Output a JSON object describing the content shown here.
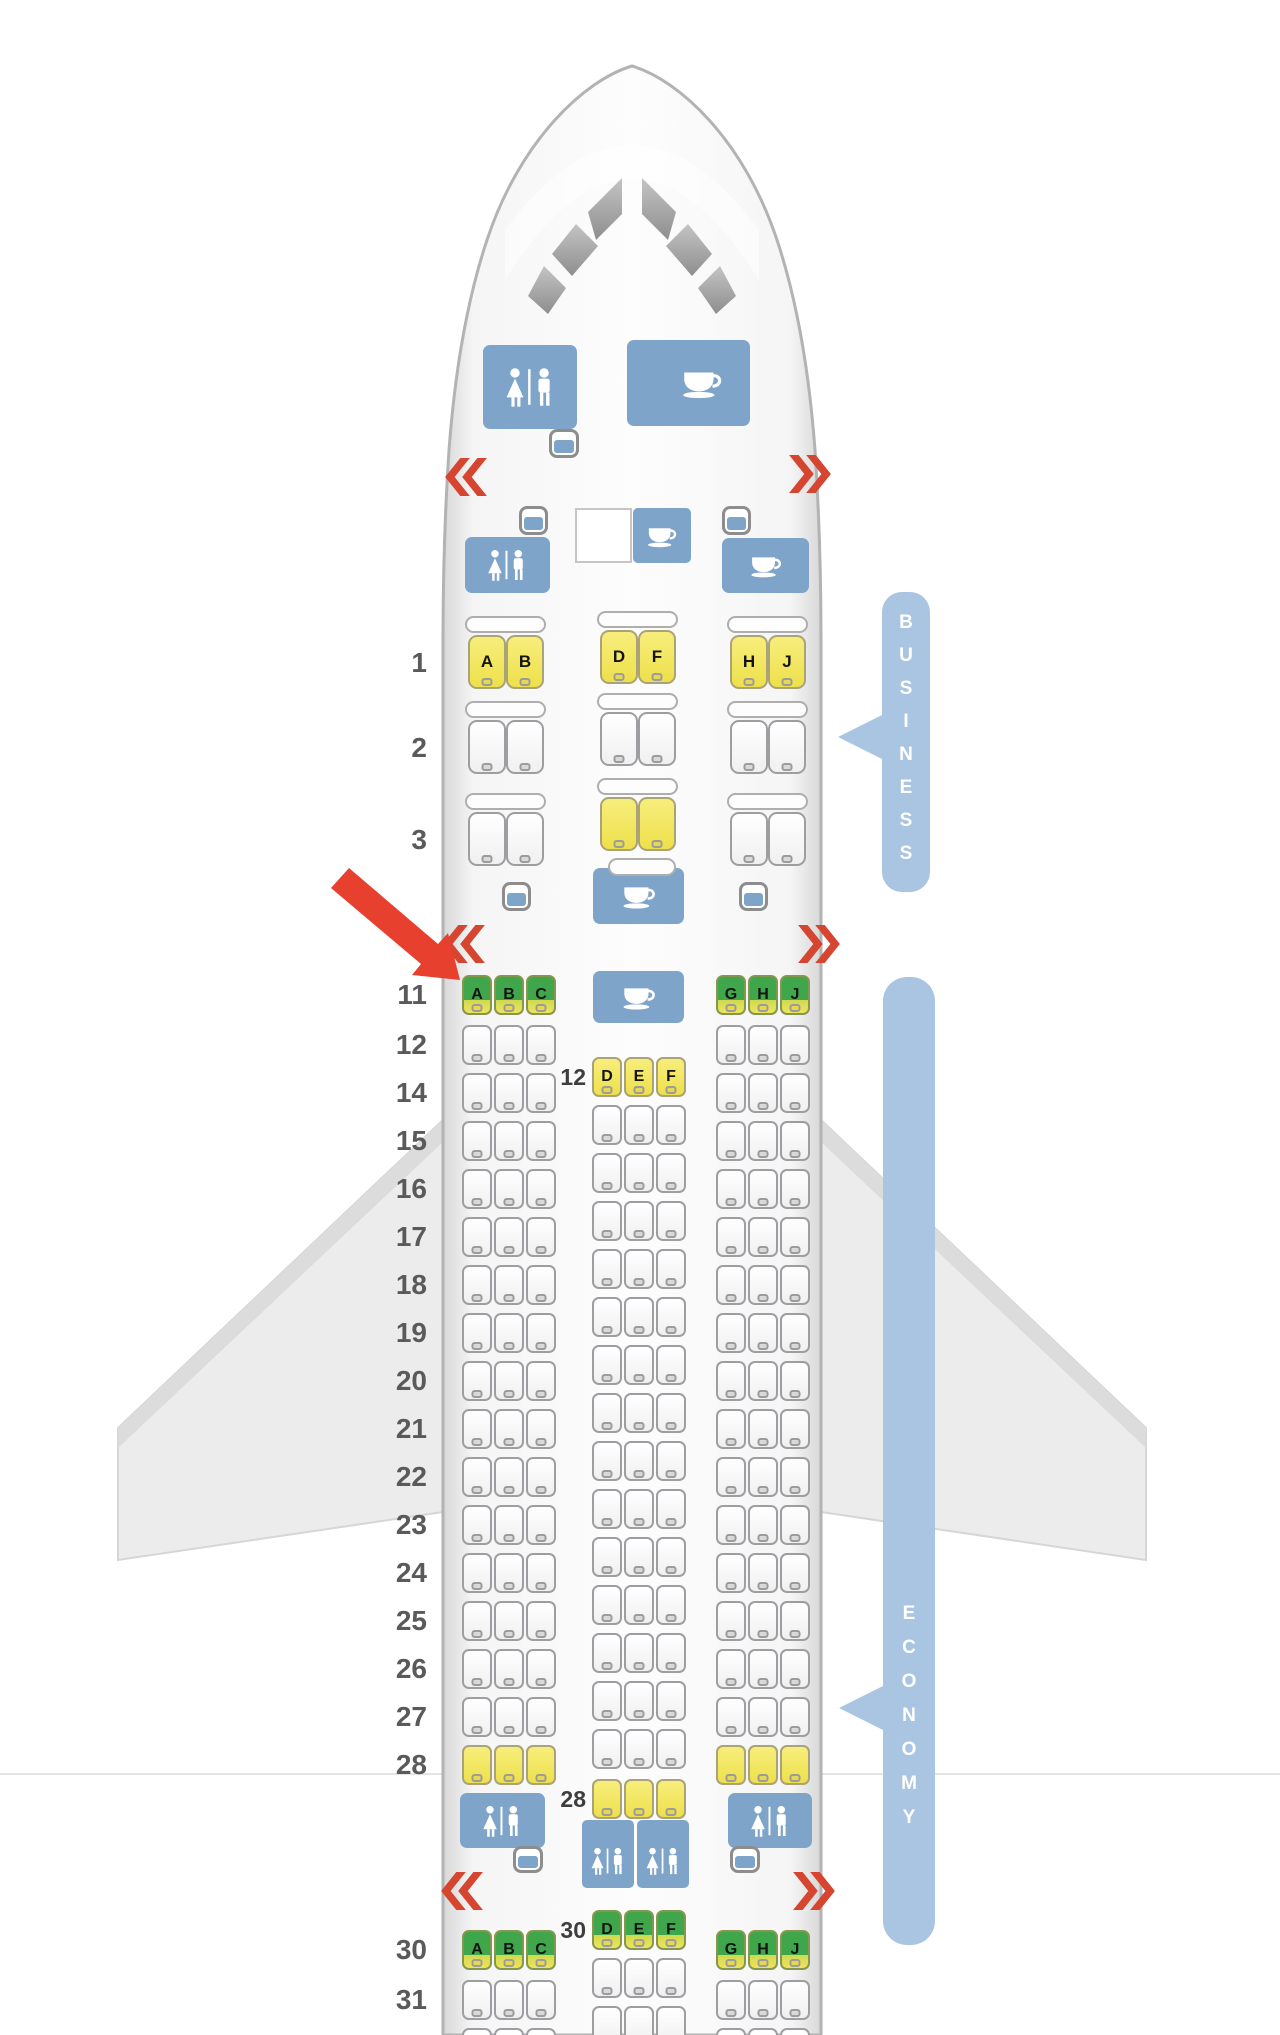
{
  "cabins": {
    "business_label": "BUSINESS",
    "economy_label": "ECONOMY"
  },
  "exits": {
    "left_glyph": "«",
    "right_glyph": "»"
  },
  "icons": {
    "lavatory": "wc-figures-icon",
    "galley": "coffee-cup-icon",
    "closet": "closet-icon",
    "exit_left": "red-double-chevron-left",
    "exit_right": "red-double-chevron-right",
    "pointer": "red-arrow-to-seat-11A"
  },
  "colors": {
    "fixture_blue": "#7ea4c9",
    "cabin_bar_blue": "#aac5e2",
    "seat_yellow": "#eee04b",
    "seat_green": "#3fa64b",
    "exit_red": "#d6452f",
    "arrow_red": "#e8402e"
  },
  "seatmap": {
    "columns": {
      "left": [
        "A",
        "B",
        "C"
      ],
      "center": [
        "D",
        "E",
        "F"
      ],
      "right": [
        "G",
        "H",
        "J"
      ]
    },
    "business_columns": {
      "left": [
        "A",
        "B"
      ],
      "center": [
        "D",
        "F"
      ],
      "right": [
        "H",
        "J"
      ]
    },
    "business_rows": [
      {
        "num": "1",
        "y_side": 635,
        "y_center": 630,
        "styles": [
          "yellow",
          "yellow",
          "yellow"
        ],
        "lettered": true
      },
      {
        "num": "2",
        "y_side": 720,
        "y_center": 712,
        "styles": [
          "white",
          "white",
          "white"
        ],
        "lettered": false
      },
      {
        "num": "3",
        "y_side": 812,
        "y_center": 797,
        "styles": [
          "white",
          "yellow",
          "white"
        ],
        "lettered": false
      }
    ],
    "side_rows": [
      {
        "num": "11",
        "y": 975,
        "style": "green",
        "lettered": true
      },
      {
        "num": "12",
        "y": 1025,
        "style": "white"
      },
      {
        "num": "14",
        "y": 1073,
        "style": "white"
      },
      {
        "num": "15",
        "y": 1121,
        "style": "white"
      },
      {
        "num": "16",
        "y": 1169,
        "style": "white"
      },
      {
        "num": "17",
        "y": 1217,
        "style": "white"
      },
      {
        "num": "18",
        "y": 1265,
        "style": "white"
      },
      {
        "num": "19",
        "y": 1313,
        "style": "white"
      },
      {
        "num": "20",
        "y": 1361,
        "style": "white"
      },
      {
        "num": "21",
        "y": 1409,
        "style": "white"
      },
      {
        "num": "22",
        "y": 1457,
        "style": "white"
      },
      {
        "num": "23",
        "y": 1505,
        "style": "white"
      },
      {
        "num": "24",
        "y": 1553,
        "style": "white"
      },
      {
        "num": "25",
        "y": 1601,
        "style": "white"
      },
      {
        "num": "26",
        "y": 1649,
        "style": "white"
      },
      {
        "num": "27",
        "y": 1697,
        "style": "white"
      },
      {
        "num": "28",
        "y": 1745,
        "style": "yellow"
      },
      {
        "num": "30",
        "y": 1930,
        "style": "green",
        "lettered": true
      },
      {
        "num": "31",
        "y": 1980,
        "style": "white"
      },
      {
        "num": "",
        "y": 2028,
        "style": "white"
      }
    ],
    "center_rows": [
      {
        "num": "12",
        "y": 1057,
        "style": "yellow",
        "lettered": true,
        "labeled": true
      },
      {
        "num": "14",
        "y": 1105,
        "style": "white"
      },
      {
        "num": "15",
        "y": 1153,
        "style": "white"
      },
      {
        "num": "16",
        "y": 1201,
        "style": "white"
      },
      {
        "num": "17",
        "y": 1249,
        "style": "white"
      },
      {
        "num": "18",
        "y": 1297,
        "style": "white"
      },
      {
        "num": "19",
        "y": 1345,
        "style": "white"
      },
      {
        "num": "20",
        "y": 1393,
        "style": "white"
      },
      {
        "num": "21",
        "y": 1441,
        "style": "white"
      },
      {
        "num": "22",
        "y": 1489,
        "style": "white"
      },
      {
        "num": "23",
        "y": 1537,
        "style": "white"
      },
      {
        "num": "24",
        "y": 1585,
        "style": "white"
      },
      {
        "num": "25",
        "y": 1633,
        "style": "white"
      },
      {
        "num": "26",
        "y": 1681,
        "style": "white"
      },
      {
        "num": "27",
        "y": 1729,
        "style": "white"
      },
      {
        "num": "28",
        "y": 1779,
        "style": "yellow",
        "labeled": true
      },
      {
        "num": "30",
        "y": 1910,
        "style": "green",
        "lettered": true,
        "labeled": true
      },
      {
        "num": "",
        "y": 1958,
        "style": "white"
      },
      {
        "num": "",
        "y": 2006,
        "style": "white"
      }
    ]
  }
}
